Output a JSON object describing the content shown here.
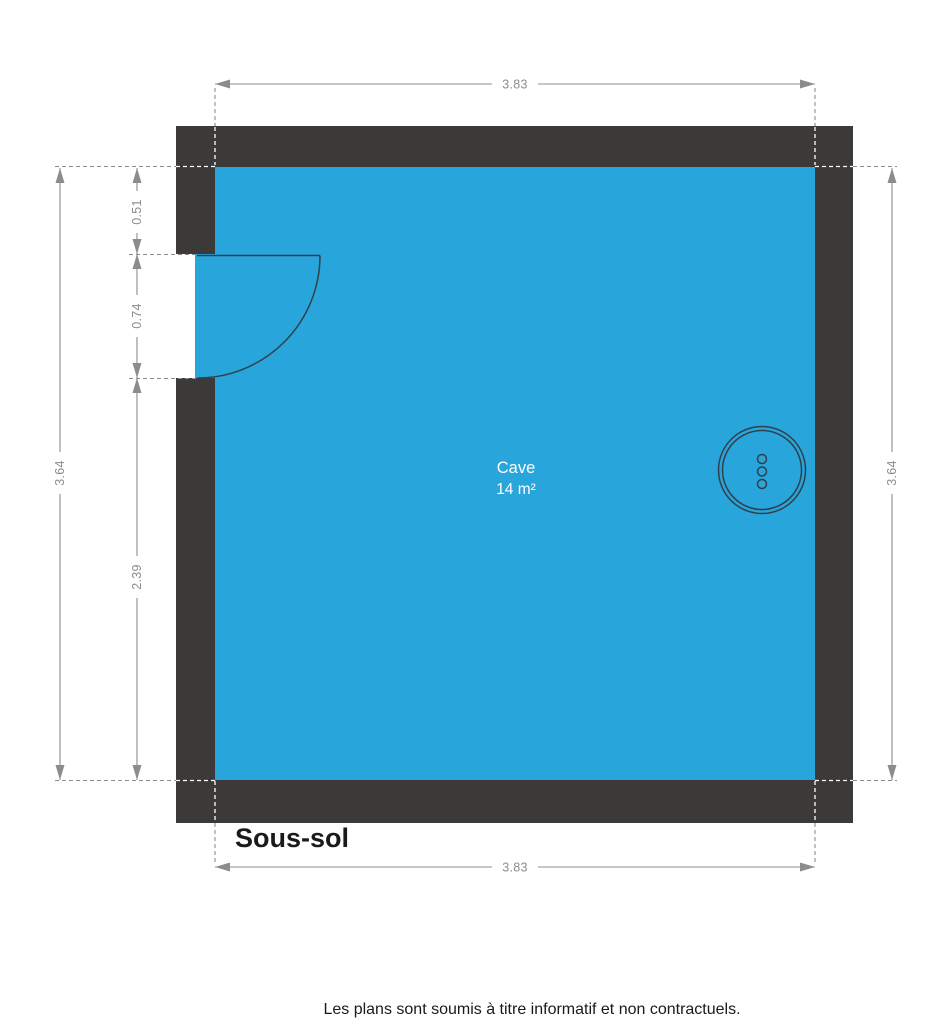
{
  "plan": {
    "floor_label": "Sous-sol",
    "room": {
      "name": "Cave",
      "area": "14 m²"
    },
    "dimensions": {
      "top": "3.83",
      "bottom": "3.83",
      "left_total": "3.64",
      "right_total": "3.64",
      "segment_upper": "0.51",
      "segment_door": "0.74",
      "segment_lower": "2.39"
    },
    "colors": {
      "wall": "#3b3a38",
      "room_fill": "#28a5da",
      "dimension": "#8c8c8c",
      "fixture_stroke": "#30404a",
      "room_text": "#ffffff",
      "label_text": "#1a1a1a"
    }
  },
  "footer": {
    "disclaimer": "Les plans sont soumis à titre informatif et non contractuels."
  }
}
